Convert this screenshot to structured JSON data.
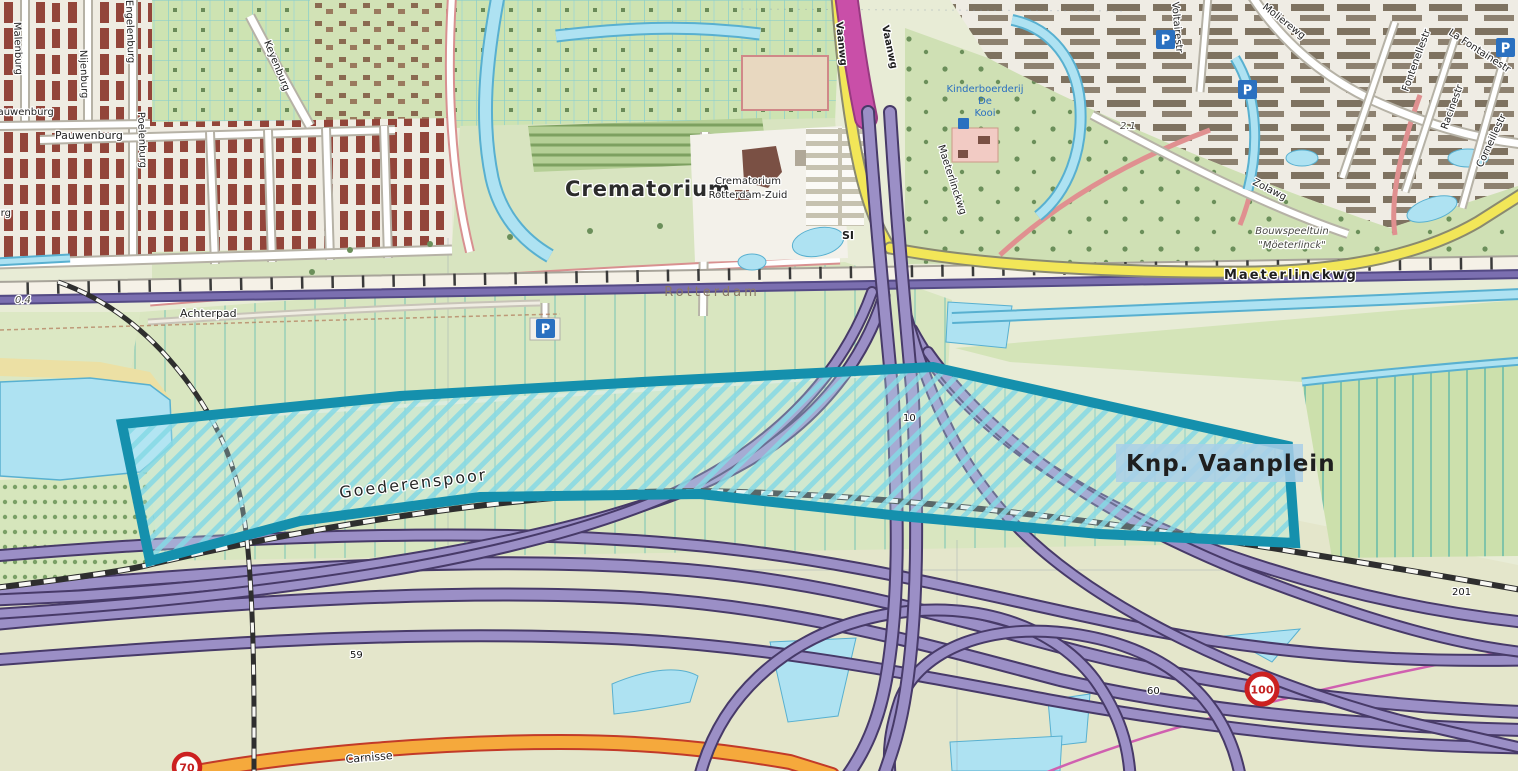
{
  "street_labels": {
    "malenburg": "Malenburg",
    "nijenburg": "Nijenburg",
    "engelenburg": "Engelenburg",
    "pauwenburg_a": "Pauwenburg",
    "pauwenburg_b": "Pauwenburg",
    "burg_fragment": "burg",
    "poelenburg": "Poelenburg",
    "keyenburg": "Keyenburg",
    "achterpad": "Achterpad",
    "vaanwg_a": "Vaanwg",
    "vaanwg_b": "Vaanwg",
    "maeterlinckwg_vertical": "Maeterlinckwg",
    "maeterlinckwg_main": "Maeterlinckwg",
    "molierewg": "Molierewg",
    "voltairestr": "Voltairestr",
    "fontenellestr": "Fontenellestr",
    "la_fontainestr": "La Fontainestr",
    "racinestr": "Racinestr",
    "corneillestr": "Corneillestr",
    "zolawg": "Zolawg",
    "carnisse": "Carnisse",
    "goederenspoor": "Goederenspoor"
  },
  "place_labels": {
    "crematorium_area": "Crematorium",
    "crematorium_name_line1": "Crematorium",
    "crematorium_name_line2": "Rotterdam-Zuid",
    "si": "SI",
    "rotterdam": "Rotterdam",
    "kinderboerderij_line1": "Kinderboerderij",
    "kinderboerderij_line2": "De",
    "kinderboerderij_line3": "Kooi",
    "bouwspeeltuin_line1": "Bouwspeeltuin",
    "bouwspeeltuin_line2": "\"Möeterlinck\""
  },
  "highlight": {
    "label": "Knp. Vaanplein",
    "outline_color": "#1590ad",
    "hatch_color": "#86d8e4",
    "label_color": "#1b6cc8",
    "label_bg": "#a9cfe8"
  },
  "markers": {
    "hm_04": "0.4",
    "hm_10": "10",
    "hm_59": "59",
    "hm_60": "60",
    "hm_201": "201",
    "hm_21": "2.1"
  },
  "signs": {
    "speed_100": "100",
    "speed_70": "70"
  },
  "icons": {
    "parking": "P"
  }
}
